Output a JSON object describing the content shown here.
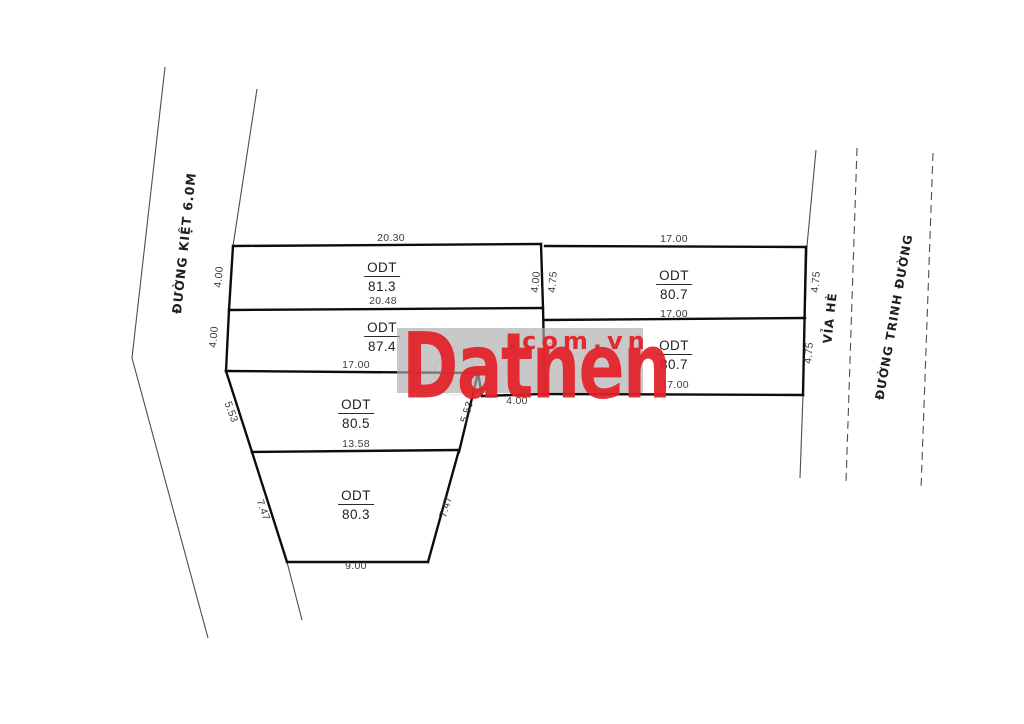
{
  "diagram": {
    "roads": {
      "left_road": "ĐƯỜNG KIỆT 6.0M",
      "sidewalk": "VỈA HÈ",
      "main_road": "ĐƯỜNG TRINH ĐƯỜNG"
    },
    "plots": [
      {
        "type_label": "ODT",
        "area": "81.3"
      },
      {
        "type_label": "ODT",
        "area": "87.4"
      },
      {
        "type_label": "ODT",
        "area": "80.5"
      },
      {
        "type_label": "ODT",
        "area": "80.3"
      },
      {
        "type_label": "ODT",
        "area": "80.7"
      },
      {
        "type_label": "ODT",
        "area": "80.7"
      }
    ],
    "dims": {
      "p1_top": "20.30",
      "p1_left": "4.00",
      "p1_right": "4.00",
      "p1_bottom": "20.48",
      "p2_left": "4.00",
      "p2_bottom": "17.00",
      "p2_step_slant": "1.60",
      "p2_step_bottom": "4.00",
      "p3_left": "5.53",
      "p3_right": "5.53",
      "p3_bottom": "13.58",
      "p4_left": "7.47",
      "p4_right": "7.47",
      "p4_bottom": "9.00",
      "r_top": "17.00",
      "r1_left": "4.75",
      "r1_right": "4.75",
      "r1_bottom": "17.00",
      "r2_left": "4.75",
      "r2_right": "4.75",
      "r2_bottom": "17.00"
    }
  },
  "watermark": {
    "brand": "Datnen",
    "suffix": ".com.vn",
    "accent_red": "#e32128",
    "band_gray": "#c7c5c5"
  }
}
